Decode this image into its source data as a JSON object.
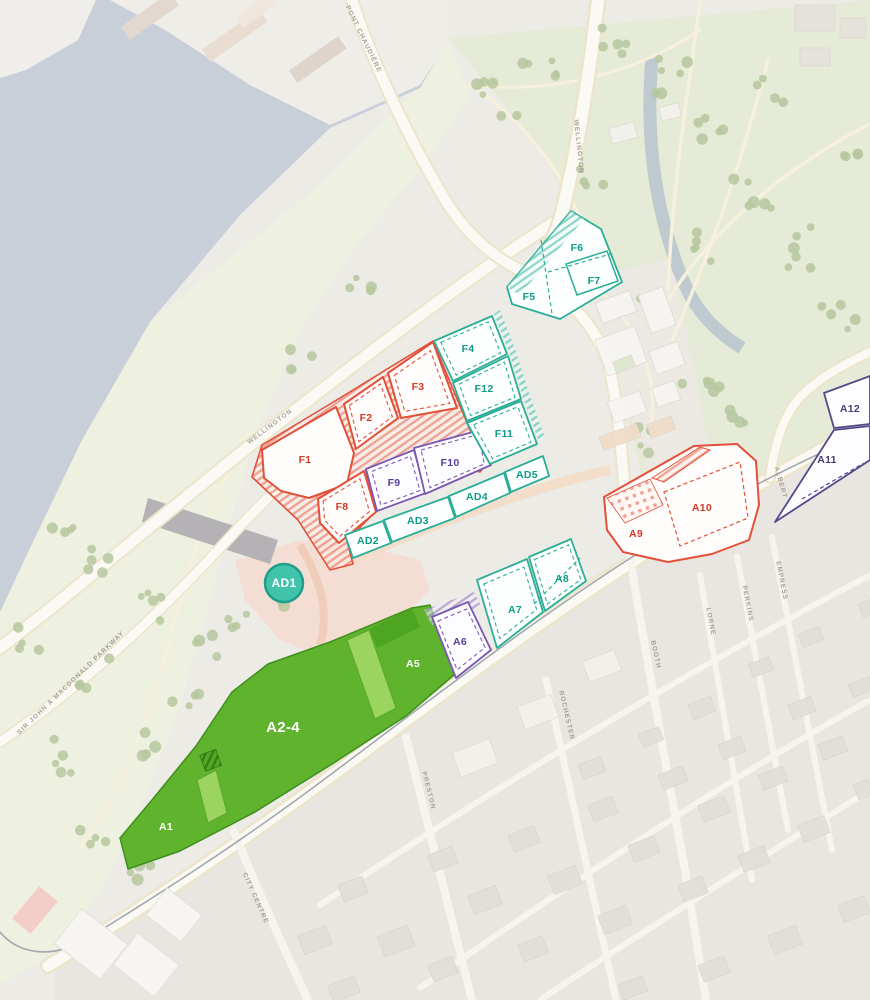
{
  "parcels": {
    "f1": {
      "label": "F1",
      "group": "red"
    },
    "f2": {
      "label": "F2",
      "group": "red"
    },
    "f3": {
      "label": "F3",
      "group": "red"
    },
    "f4": {
      "label": "F4",
      "group": "teal"
    },
    "f5": {
      "label": "F5",
      "group": "teal"
    },
    "f6": {
      "label": "F6",
      "group": "teal"
    },
    "f7": {
      "label": "F7",
      "group": "teal"
    },
    "f8": {
      "label": "F8",
      "group": "red"
    },
    "f9": {
      "label": "F9",
      "group": "purple"
    },
    "f10": {
      "label": "F10",
      "group": "purple"
    },
    "f11": {
      "label": "F11",
      "group": "teal"
    },
    "f12": {
      "label": "F12",
      "group": "teal"
    },
    "ad1": {
      "label": "AD1",
      "group": "badge"
    },
    "ad2": {
      "label": "AD2",
      "group": "teal"
    },
    "ad3": {
      "label": "AD3",
      "group": "teal"
    },
    "ad4": {
      "label": "AD4",
      "group": "teal"
    },
    "ad5": {
      "label": "AD5",
      "group": "teal"
    },
    "a1": {
      "label": "A1",
      "group": "green"
    },
    "a2_4": {
      "label": "A2-4",
      "group": "green"
    },
    "a5": {
      "label": "A5",
      "group": "green"
    },
    "a6": {
      "label": "A6",
      "group": "purple"
    },
    "a7": {
      "label": "A7",
      "group": "teal"
    },
    "a8": {
      "label": "A8",
      "group": "teal"
    },
    "a9": {
      "label": "A9",
      "group": "red"
    },
    "a10": {
      "label": "A10",
      "group": "red"
    },
    "a11": {
      "label": "A11",
      "group": "dark_purple"
    },
    "a12": {
      "label": "A12",
      "group": "dark_purple"
    }
  },
  "streets": {
    "pont_chaudiere": "PONT CHAUDIÈRE",
    "wellington": "WELLINGTON",
    "sir_john_a_macdonald_parkway": "SIR JOHN A MACDONALD PARKWAY",
    "albert": "ALBERT",
    "city_centre": "CITY CENTRE",
    "preston": "PRESTON",
    "rochester": "ROCHESTER",
    "booth": "BOOTH",
    "lorne": "LORNE",
    "perkins": "PERKINS",
    "empress": "EMPRESS"
  },
  "colors": {
    "red_outline": "#e2503a",
    "teal_outline": "#2aae97",
    "purple_outline": "#7a58b0",
    "dark_purple_outline": "#55498a",
    "green_fill": "#5fb32d",
    "green_light": "#9bd45f",
    "badge_fill": "#41c3ab",
    "water": "#c8cfd9"
  }
}
